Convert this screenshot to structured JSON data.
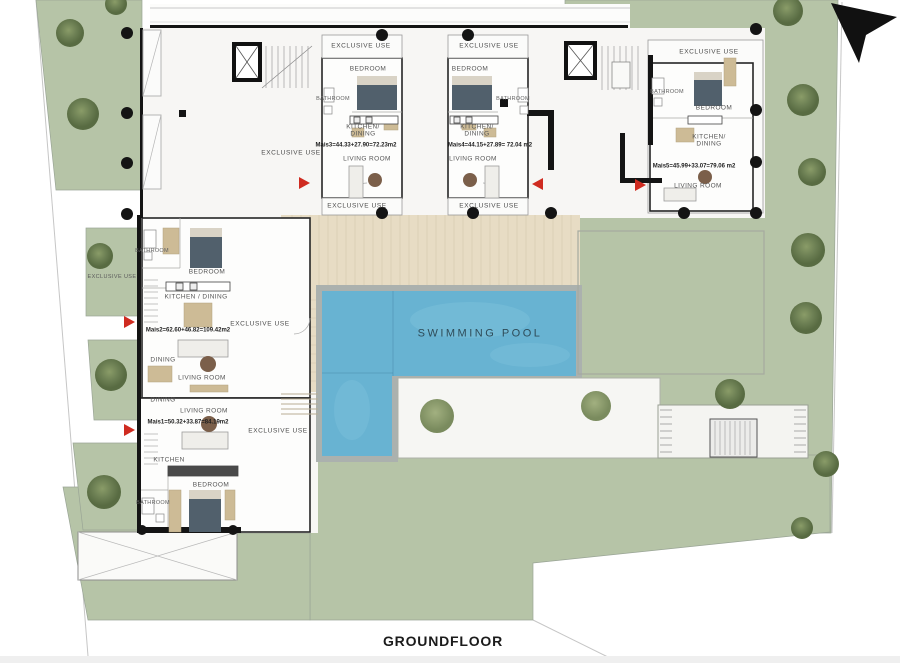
{
  "title": "GROUNDFLOOR",
  "pool": {
    "label": "SWIMMING POOL"
  },
  "exclusive_use_label": "EXCLUSIVE USE",
  "units": {
    "mais3": {
      "annotation": "Mais3=44.33+27.90=72.23m2",
      "rooms": {
        "bedroom": "BEDROOM",
        "bathroom": "BATHROOM",
        "kitchen_dining": "KITCHEN/\nDINING",
        "living": "LIVING ROOM"
      }
    },
    "mais4": {
      "annotation": "Mais4=44.15+27.89= 72.04 m2",
      "rooms": {
        "bedroom": "BEDROOM",
        "bathroom": "BATHROOM",
        "kitchen_dining": "KITCHEN/\nDINING",
        "living": "LIVING ROOM"
      }
    },
    "mais5": {
      "annotation": "Mais5=45.99+33.07=79.06 m2",
      "rooms": {
        "bathroom": "BATHROOM",
        "bedroom": "BEDROOM",
        "kitchen_dining": "KITCHEN/\nDINING",
        "living": "LIVING ROOM"
      }
    },
    "mais2": {
      "annotation": "Mais2=62.60+46.82=109.42m2",
      "rooms": {
        "bathroom": "BATHROOM",
        "bedroom": "BEDROOM",
        "kitchen_dining": "KITCHEN / DINING",
        "dining": "DINING",
        "living": "LIVING ROOM"
      }
    },
    "mais1": {
      "annotation": "Mais1=50.32+33.87=84.19m2",
      "rooms": {
        "dining": "DINING",
        "living": "LIVING ROOM",
        "kitchen": "KITCHEN",
        "bedroom": "BEDROOM",
        "bathroom": "BATHROOM"
      }
    }
  },
  "colors": {
    "lawn": "#b6c4a7",
    "tree_dark": "#6d8054",
    "pool_water": "#68b3d2",
    "deck": "#e7dcc4",
    "wall": "#141414",
    "marker_red": "#cf2b20"
  }
}
